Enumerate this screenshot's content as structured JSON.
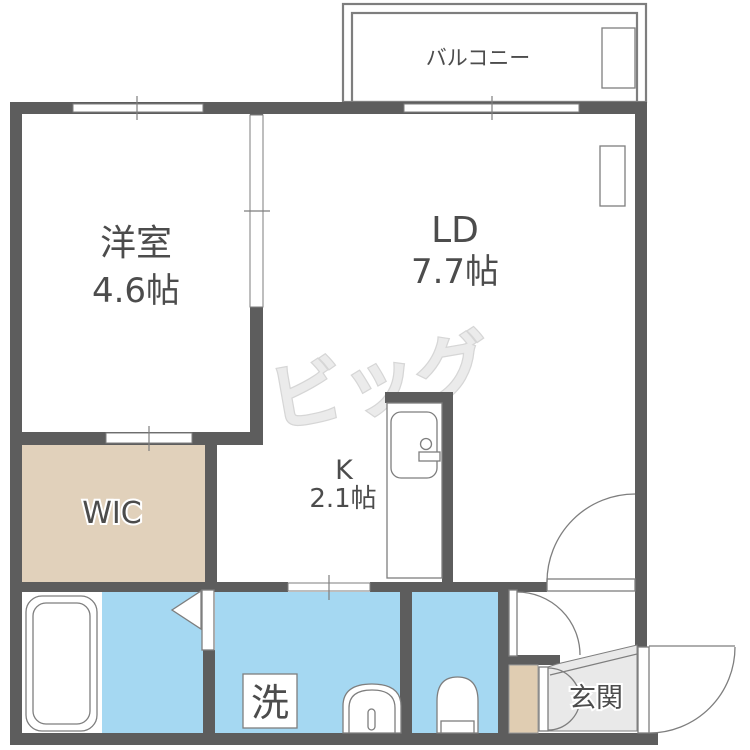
{
  "colors": {
    "wall": "#5d5d5d",
    "line": "#7e7e7e",
    "water_blue": "#a5d8f2",
    "wic_beige": "#e1d1bb",
    "shoe_beige": "#e0cdb2",
    "genkan_gray": "#e9e9e9",
    "label": "#4c4c4c",
    "watermark_fill": "#ebebeb",
    "watermark_stroke": "#d6d6d6"
  },
  "labels": {
    "balcony": "バルコニー",
    "western_room": "洋室",
    "western_room_size": "4.6帖",
    "living_dining": "LD",
    "living_dining_size": "7.7帖",
    "kitchen": "K",
    "kitchen_size": "2.1帖",
    "wic": "WIC",
    "washer": "洗",
    "entrance": "玄関",
    "watermark": "ビッグ"
  }
}
